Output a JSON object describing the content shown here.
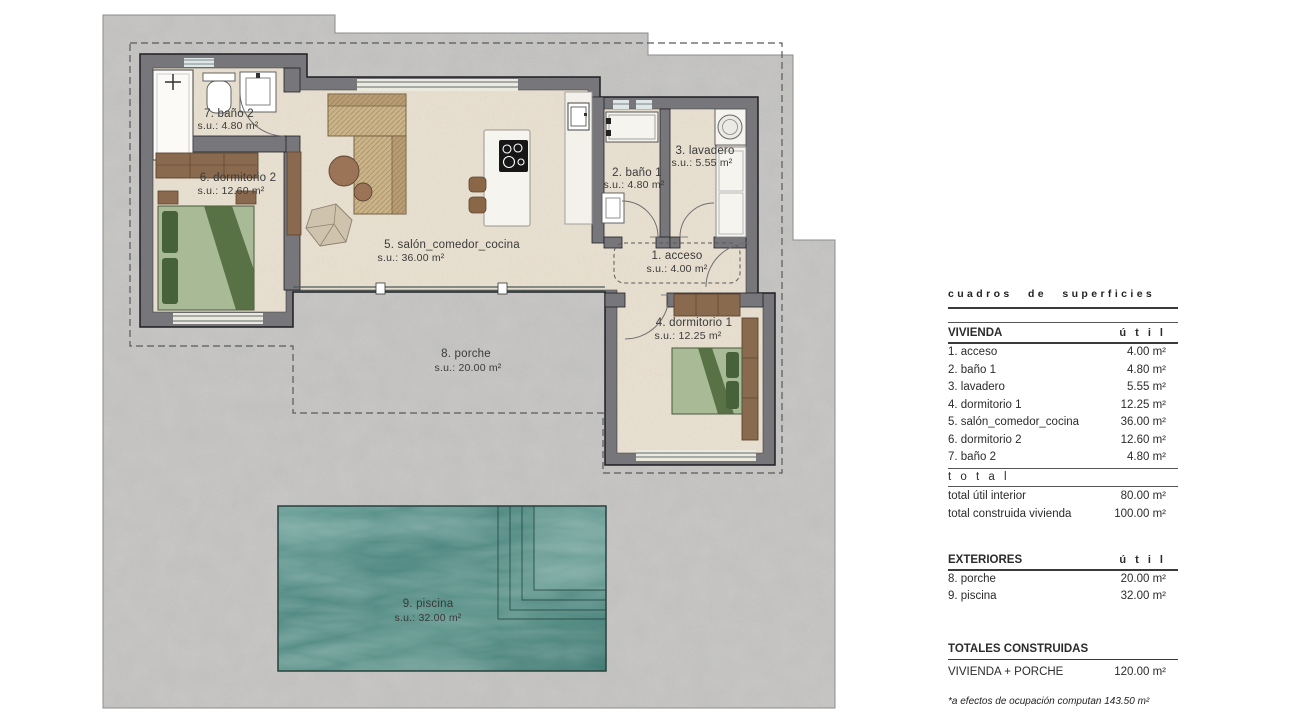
{
  "plan": {
    "rooms": [
      {
        "name": "1. acceso",
        "area": "s.u.: 4.00 m²"
      },
      {
        "name": "2. baño 1",
        "area": "s.u.: 4.80 m²"
      },
      {
        "name": "3. lavadero",
        "area": "s.u.: 5.55 m²"
      },
      {
        "name": "4. dormitorio 1",
        "area": "s.u.: 12.25 m²"
      },
      {
        "name": "5. salón_comedor_cocina",
        "area": "s.u.: 36.00 m²"
      },
      {
        "name": "6. dormitorio 2",
        "area": "s.u.: 12.60 m²"
      },
      {
        "name": "7. baño 2",
        "area": "s.u.: 4.80 m²"
      },
      {
        "name": "8. porche",
        "area": "s.u.: 20.00 m²"
      },
      {
        "name": "9. piscina",
        "area": "s.u.: 32.00 m²"
      }
    ]
  },
  "table": {
    "title": "cuadros de superficies",
    "vivienda": {
      "header": "VIVIENDA",
      "unit": "ú t i l",
      "rows": [
        {
          "label": "1. acceso",
          "value": "4.00 m²"
        },
        {
          "label": "2. baño 1",
          "value": "4.80 m²"
        },
        {
          "label": "3. lavadero",
          "value": "5.55 m²"
        },
        {
          "label": "4. dormitorio 1",
          "value": "12.25 m²"
        },
        {
          "label": "5. salón_comedor_cocina",
          "value": "36.00 m²"
        },
        {
          "label": "6. dormitorio 2",
          "value": "12.60 m²"
        },
        {
          "label": "7. baño 2",
          "value": "4.80 m²"
        }
      ],
      "subtotal_label": "t o t a l",
      "totals": [
        {
          "label": "total útil interior",
          "value": "80.00 m²"
        },
        {
          "label": "total construida vivienda",
          "value": "100.00 m²"
        }
      ]
    },
    "exteriores": {
      "header": "EXTERIORES",
      "unit": "ú t i l",
      "rows": [
        {
          "label": "8. porche",
          "value": "20.00 m²"
        },
        {
          "label": "9. piscina",
          "value": "32.00 m²"
        }
      ]
    },
    "totales": {
      "header": "TOTALES CONSTRUIDAS",
      "rows": [
        {
          "label": "VIVIENDA + PORCHE",
          "value": "120.00 m²"
        }
      ]
    },
    "footnote": "*a efectos de ocupación computan 143.50 m²"
  },
  "colors": {
    "terrain": "#cbcac8",
    "floor": "#e9e1d2",
    "wall": "#77777b",
    "pool_teal": "#54908a",
    "wood": "#8a6a4e",
    "bed_green": "#a9ba97",
    "bed_green_dark": "#47623a",
    "dashed_line": "#5a5a5a"
  }
}
